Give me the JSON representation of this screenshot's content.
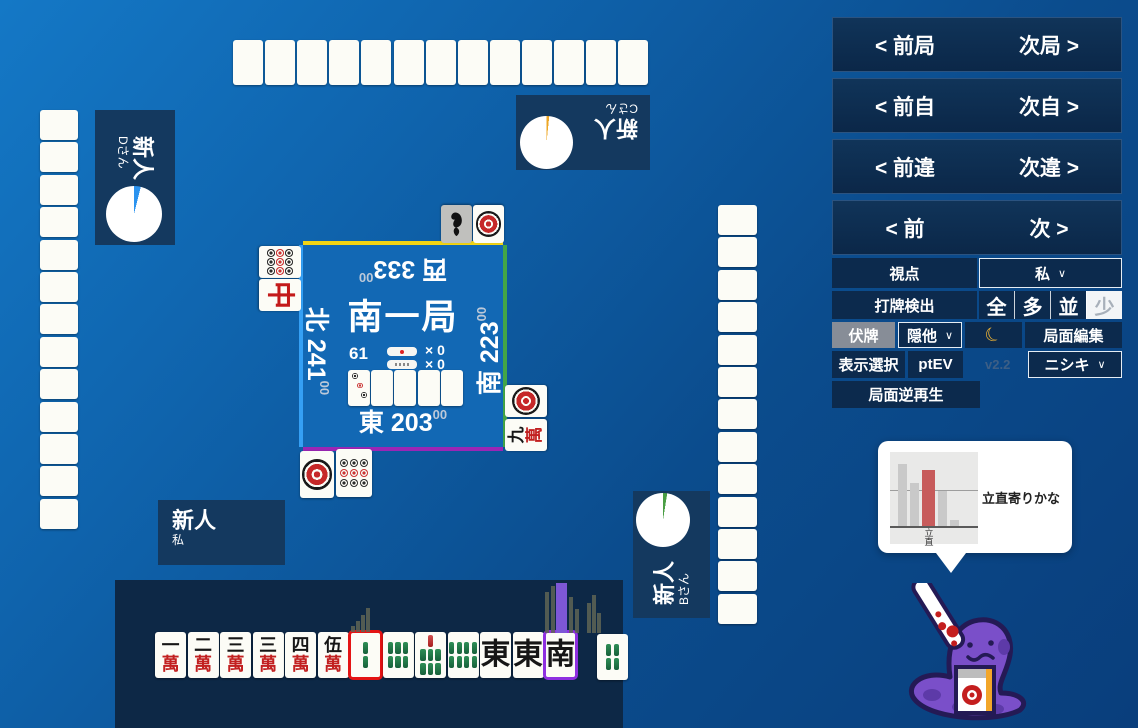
{
  "nav": [
    {
      "prev": "< 前局",
      "next": "次局 >"
    },
    {
      "prev": "< 前自",
      "next": "次自 >"
    },
    {
      "prev": "< 前違",
      "next": "次違 >"
    },
    {
      "prev": "< 前",
      "next": "次 >"
    }
  ],
  "controls": {
    "viewpoint": {
      "label": "視点",
      "value": "私"
    },
    "dahai": {
      "label": "打牌検出",
      "options": [
        "全",
        "多",
        "並",
        "少"
      ],
      "selected": "少"
    },
    "fusehai": {
      "label": "伏牌",
      "select_value": "隠他"
    },
    "moon_icon": "☾",
    "kyokumen_edit": "局面編集",
    "display_select": "表示選択",
    "ptev": "ptEV",
    "version": "v2.2",
    "engine": "ニシキ",
    "reverse_replay": "局面逆再生"
  },
  "board": {
    "round": "南一局",
    "wall_count": "61",
    "riichi_count": "× 0",
    "honba_count": "× 0",
    "seats": {
      "top": {
        "wind": "西",
        "score": "333",
        "cents": "00",
        "border": "#f2d413"
      },
      "right": {
        "wind": "南",
        "score": "223",
        "cents": "00",
        "border": "#43a547"
      },
      "bottom": {
        "wind": "東",
        "score": "203",
        "cents": "00",
        "border": "#9b26b5"
      },
      "left": {
        "wind": "北",
        "score": "241",
        "cents": "00",
        "border": "#35a0f5"
      }
    },
    "dora": {
      "revealed": "3p",
      "hidden": 4
    }
  },
  "players": {
    "bottom": {
      "rank": "新人",
      "name": "私"
    },
    "right": {
      "rank": "新人",
      "name": "Bさん",
      "timer_color": "#4a9e44",
      "timer_deg": 9
    },
    "top": {
      "rank": "新人",
      "name": "Cさん",
      "timer_color": "#eda726",
      "timer_deg": 6
    },
    "left": {
      "rank": "新人",
      "name": "Dさん",
      "timer_color": "#2b93ef",
      "timer_deg": 14
    }
  },
  "hand": {
    "tiles": [
      "1m",
      "2m",
      "3m",
      "3m",
      "4m",
      "5m",
      "2s",
      "6s",
      "7s",
      "8s",
      "E",
      "E",
      "S"
    ],
    "drawn": "4s",
    "red_index": 6,
    "purple_index": 12
  },
  "discards": {
    "top": [
      {
        "t": "1s",
        "gray": true
      },
      {
        "t": "1p"
      }
    ],
    "left": [
      {
        "t": "9p"
      },
      {
        "t": "C"
      }
    ],
    "right": [
      {
        "t": "1p"
      },
      {
        "t": "9m"
      }
    ],
    "bottom": [
      {
        "t": "1p"
      },
      {
        "t": "9p"
      }
    ]
  },
  "walls": {
    "top": 13,
    "left": 13,
    "right": 13
  },
  "tooltip": {
    "text": "立直寄りかな",
    "chart_data": {
      "type": "bar",
      "categories": [
        "",
        "",
        "立直",
        "",
        ""
      ],
      "values": [
        0.88,
        0.62,
        0.8,
        0.5,
        0.08
      ],
      "colors": [
        "#c9c9c9",
        "#c9c9c9",
        "#c75b5b",
        "#c9c9c9",
        "#c9c9c9"
      ],
      "highlight_label": "立直"
    }
  },
  "histograms": {
    "small": [
      6,
      11,
      17,
      24
    ],
    "main": [
      {
        "x": 545,
        "w": 4,
        "h": 41,
        "c": "gray"
      },
      {
        "x": 551,
        "w": 4,
        "h": 47,
        "c": "gray"
      },
      {
        "x": 556,
        "w": 11,
        "h": 50,
        "c": "purple"
      },
      {
        "x": 569,
        "w": 4,
        "h": 36,
        "c": "gray"
      },
      {
        "x": 575,
        "w": 4,
        "h": 24,
        "c": "gray"
      },
      {
        "x": 587,
        "w": 4,
        "h": 30,
        "c": "gray"
      },
      {
        "x": 592,
        "w": 4,
        "h": 38,
        "c": "gray"
      },
      {
        "x": 597,
        "w": 4,
        "h": 20,
        "c": "gray"
      }
    ]
  }
}
